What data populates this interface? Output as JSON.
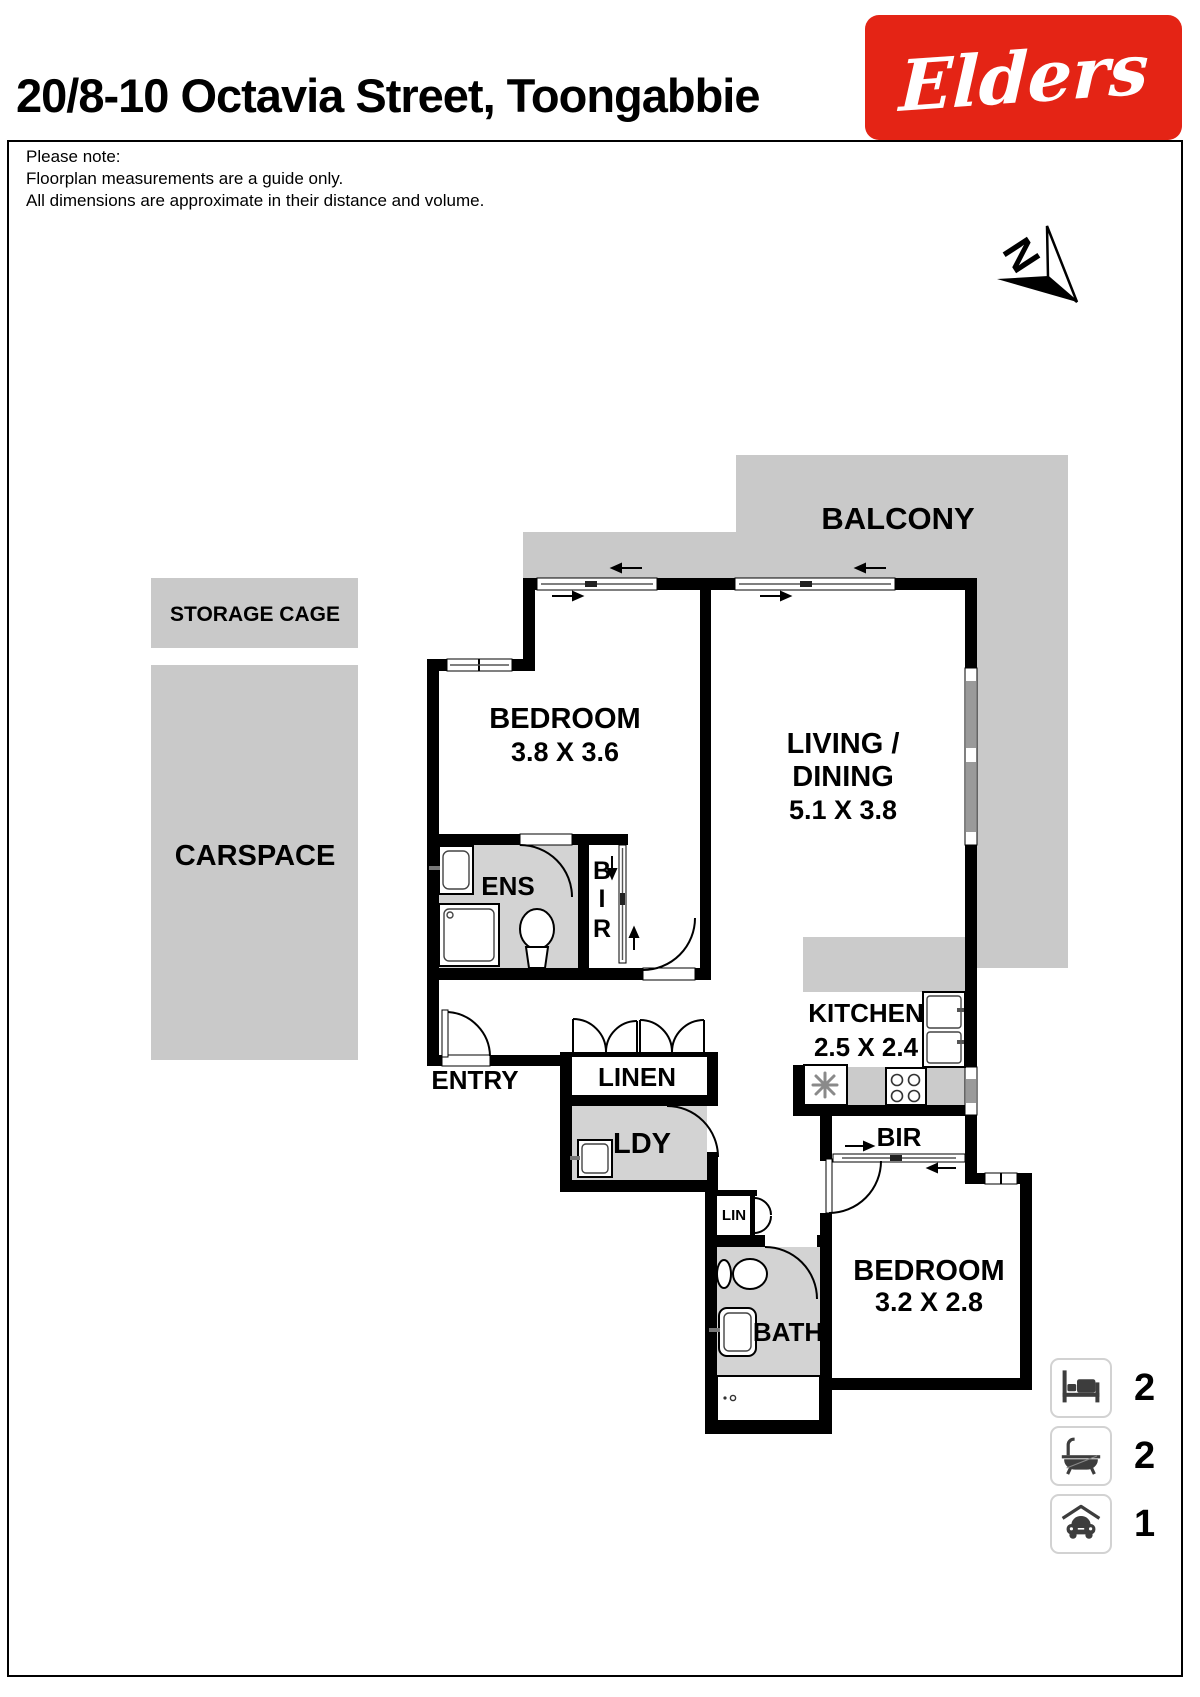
{
  "header": {
    "title": "20/8-10 Octavia Street, Toongabbie",
    "brand": "Elders",
    "brand_color": "#e42415"
  },
  "disclaimer": {
    "line1": "Please note:",
    "line2": "Floorplan measurements are a guide only.",
    "line3": "All dimensions are approximate in their distance and volume."
  },
  "compass": {
    "label": "N"
  },
  "plan": {
    "areas": {
      "balcony": "BALCONY",
      "storage": "STORAGE CAGE",
      "carspace": "CARSPACE",
      "bedroom1": "BEDROOM",
      "bedroom1_dims": "3.8 X 3.6",
      "living_line1": "LIVING /",
      "living_line2": "DINING",
      "living_dims": "5.1 X 3.8",
      "ens": "ENS",
      "bir_letters": [
        "B",
        "I",
        "R"
      ],
      "entry": "ENTRY",
      "linen": "LINEN",
      "ldy": "LDY",
      "kitchen": "KITCHEN",
      "kitchen_dims": "2.5 X 2.4",
      "bir2": "BIR",
      "lin": "LIN",
      "bath": "BATH",
      "bedroom2": "BEDROOM",
      "bedroom2_dims": "3.2 X 2.8"
    }
  },
  "summary": {
    "beds": "2",
    "baths": "2",
    "cars": "1"
  },
  "colors": {
    "wall": "#000000",
    "balcony_gray": "#c9c9c9",
    "room_gray": "#d3d3d3"
  }
}
